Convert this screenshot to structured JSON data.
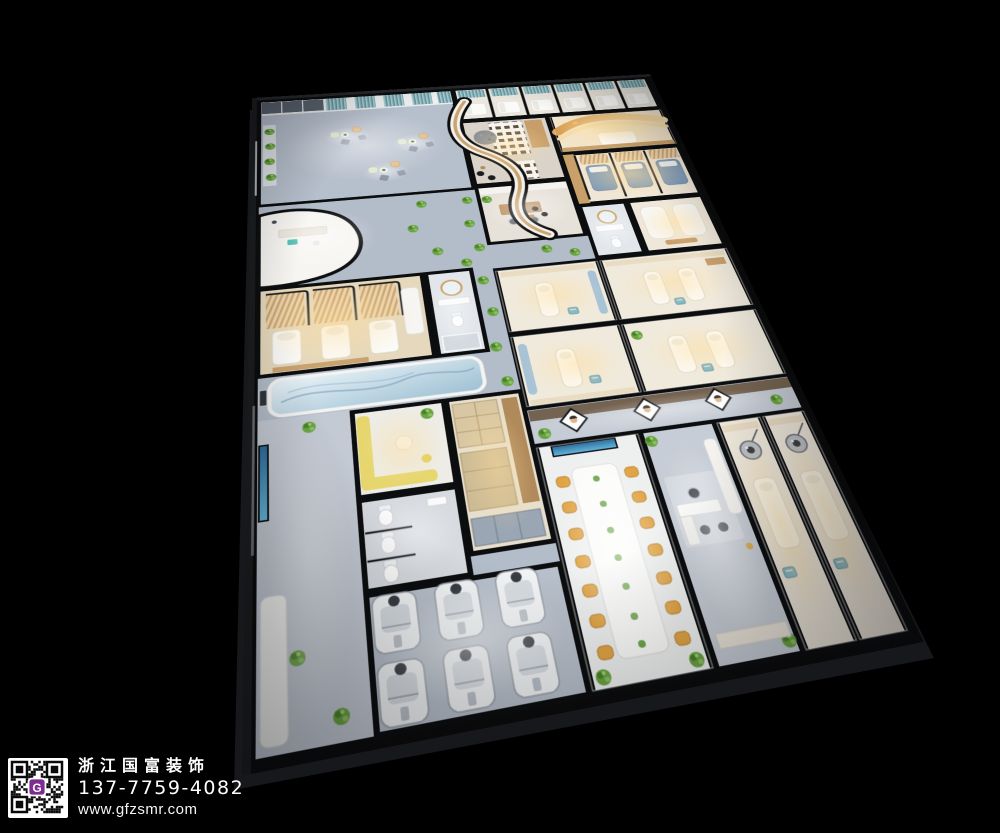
{
  "watermark": {
    "company": "浙江国富装饰",
    "phone": "137-7759-4082",
    "website": "www.gfzsmr.com",
    "qr_logo_letter": "G"
  },
  "palette": {
    "background": "#000000",
    "corridor_floor": "#b3bcc9",
    "warm_room_floor": "#efe7d8",
    "curtain_teal": "#6f9fa8",
    "gold_accent": "#dcab67",
    "conference_chair_orange": "#e0a445",
    "sofa_yellow": "#e6d66d",
    "plant_green": "#6aa342",
    "treatment_bed_blue": "#7e9ab8",
    "mural_blue": "#9fc0d4",
    "tv_screen_blue": "#3f82b0",
    "qr_logo_purple": "#7c2d8f",
    "watermark_text_color": "#ffffff"
  }
}
